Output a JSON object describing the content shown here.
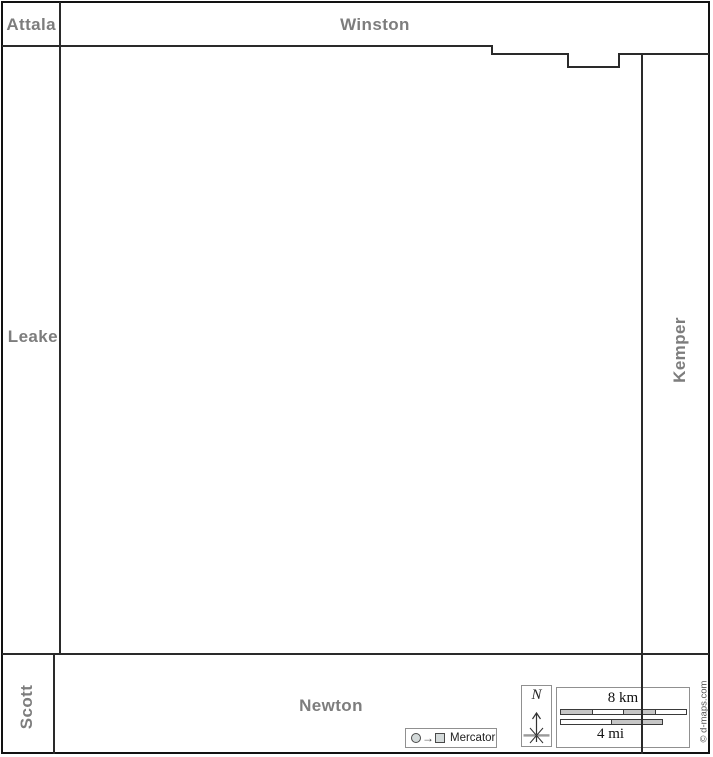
{
  "map_labels": {
    "attala": "Attala",
    "winston": "Winston",
    "leake": "Leake",
    "kemper": "Kemper",
    "scott": "Scott",
    "newton": "Newton"
  },
  "projection_box": {
    "label": "Mercator"
  },
  "compass": {
    "north": "N"
  },
  "scale_bar": {
    "km": "8 km",
    "mi": "4 mi"
  },
  "credit": "© d-maps.com",
  "colors": {
    "label_gray": "#7d7d7d",
    "boundary": "#2a2a2a",
    "bar_fill_gray": "#c6c6c6",
    "box_border_gray": "#909090"
  }
}
